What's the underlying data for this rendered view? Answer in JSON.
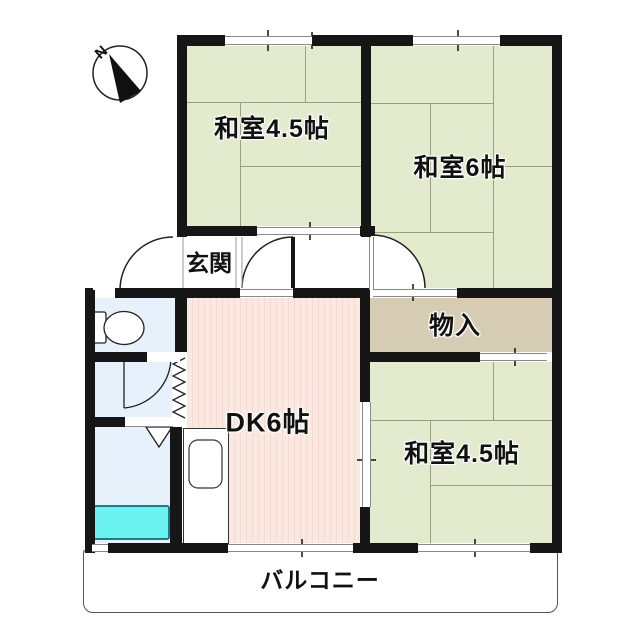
{
  "compass": {
    "label": "N"
  },
  "rooms": {
    "japanese_room_top_left": {
      "label": "和室4.5帖",
      "type": "tatami"
    },
    "japanese_room_top_right": {
      "label": "和室6帖",
      "type": "tatami"
    },
    "entrance": {
      "label": "玄関"
    },
    "storage": {
      "label": "物入"
    },
    "dining_kitchen": {
      "label": "DK6帖"
    },
    "japanese_room_bottom_right": {
      "label": "和室4.5帖",
      "type": "tatami"
    },
    "balcony": {
      "label": "バルコニー"
    }
  },
  "colors": {
    "tatami_green": "#e2ebcd",
    "dk_pink": "#fbe9e1",
    "storage_tan": "#d6ccb3",
    "wet_area_blue": "#e6f1fb",
    "bathtub_cyan": "#6cf3f1",
    "wall_black": "#161616"
  }
}
